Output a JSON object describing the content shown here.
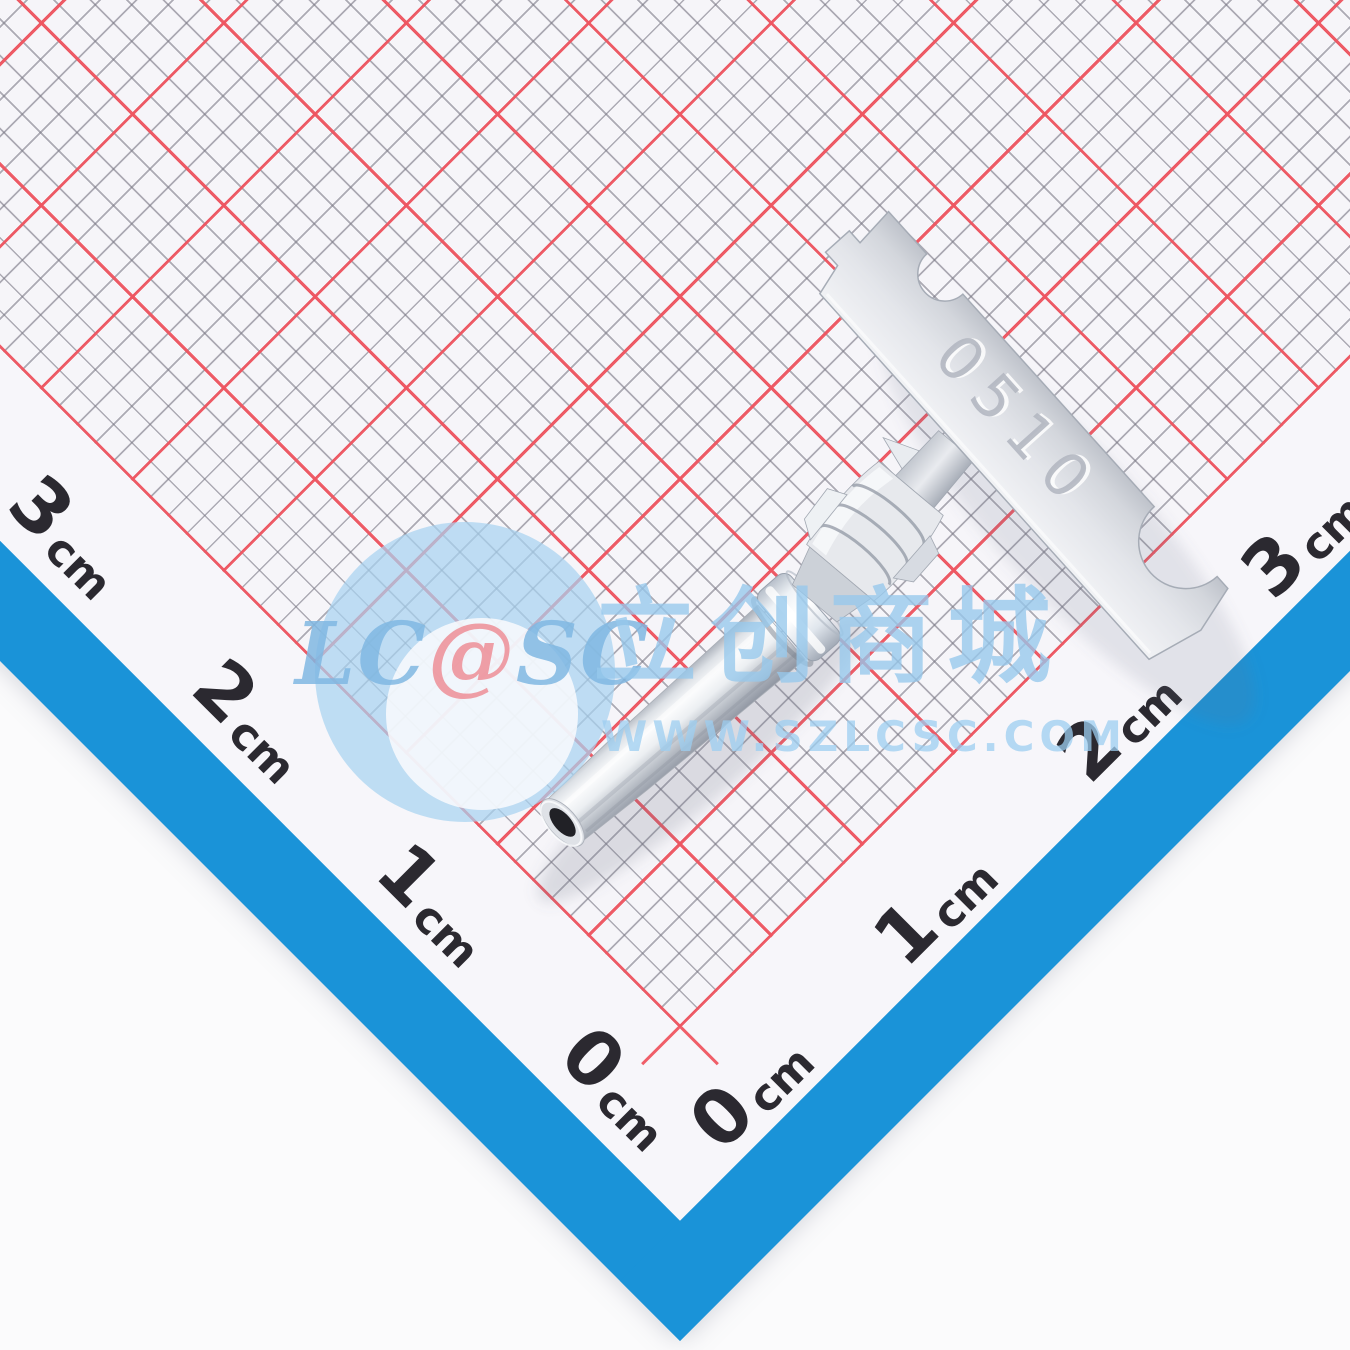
{
  "image": {
    "type": "product-photo",
    "subject": "silver crimp terminal pin (machined socket contact) with flat carrier-strip tab, lying diagonally on millimeter graph paper",
    "stamp_marking": "0510"
  },
  "ruler": {
    "unit": "cm",
    "left_axis": [
      {
        "num": "0",
        "unit": "cm"
      },
      {
        "num": "1",
        "unit": "cm"
      },
      {
        "num": "2",
        "unit": "cm"
      },
      {
        "num": "3",
        "unit": "cm"
      }
    ],
    "right_axis": [
      {
        "num": "0",
        "unit": "cm"
      },
      {
        "num": "1",
        "unit": "cm"
      },
      {
        "num": "2",
        "unit": "cm"
      },
      {
        "num": "3",
        "unit": "cm"
      }
    ]
  },
  "watermark": {
    "lc": "LC",
    "at": "@",
    "sc": "SC",
    "brand_cn": "立创商城",
    "url": "WWW.SZLCSC.COM"
  },
  "colors": {
    "border_blue": "#1a93d8",
    "grid_red": "#ef5560",
    "grid_fine_gray": "#7a7885",
    "paper_white": "#f6f5f9",
    "metal_light": "#fafbfc",
    "metal_mid": "#d7dade",
    "metal_dark": "#9aa0aa",
    "tip_hole": "#212126",
    "watermark_blue": "#a8d2ec",
    "watermark_red": "#ec808a"
  }
}
